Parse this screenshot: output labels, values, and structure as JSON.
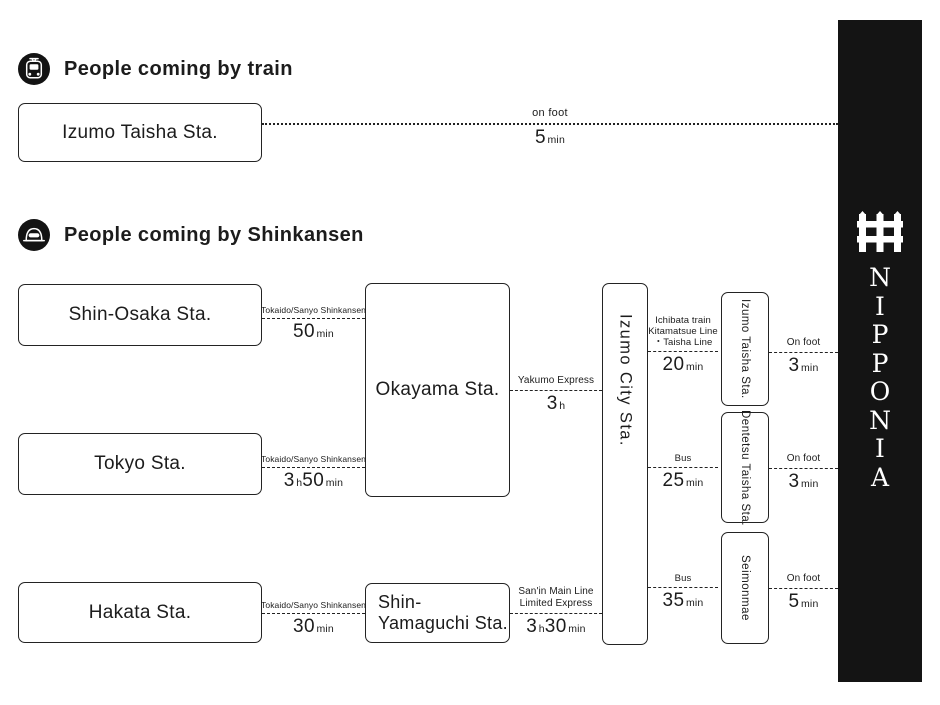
{
  "sections": {
    "train": {
      "heading": "People coming by train"
    },
    "shinkansen": {
      "heading": "People coming by Shinkansen"
    }
  },
  "stations": {
    "izumo_taisha_train": "Izumo Taisha Sta.",
    "shin_osaka": "Shin-Osaka Sta.",
    "tokyo": "Tokyo Sta.",
    "hakata": "Hakata Sta.",
    "okayama": "Okayama Sta.",
    "shin_yamaguchi": {
      "line1": "Shin-",
      "line2": "Yamaguchi Sta."
    },
    "izumo_city": "Izumo City Sta.",
    "izumo_taisha": "Izumo Taisha Sta.",
    "dentetsu_taisha": "Dentetsu Taisha Sta.",
    "seimonmae": "Seimonmae"
  },
  "routes": {
    "train_onfoot": {
      "l1": "on foot",
      "v1": "5",
      "u1": "min",
      "v2": "",
      "u2": ""
    },
    "shinosaka_okayama": {
      "l1": "Tokaido/Sanyo Shinkansen",
      "v1": "50",
      "u1": "min",
      "v2": "",
      "u2": ""
    },
    "tokyo_okayama": {
      "l1": "Tokaido/Sanyo Shinkansen",
      "v1": "3",
      "u1": "h",
      "v2": "50",
      "u2": "min"
    },
    "hakata_shinyamaguchi": {
      "l1": "Tokaido/Sanyo Shinkansen",
      "v1": "30",
      "u1": "min",
      "v2": "",
      "u2": ""
    },
    "okayama_izumocity": {
      "l1": "Yakumo Express",
      "v1": "3",
      "u1": "h",
      "v2": "",
      "u2": ""
    },
    "shinyamaguchi_izumocity": {
      "l1": "San'in Main Line",
      "l2": "Limited Express",
      "v1": "3",
      "u1": "h",
      "v2": "30",
      "u2": "min"
    },
    "izumocity_izumotaisha": {
      "l1": "Ichibata train",
      "l2": "Kitamatsue Line",
      "l3": "・Taisha Line",
      "v1": "20",
      "u1": "min",
      "v2": "",
      "u2": ""
    },
    "izumocity_dentetsu": {
      "l1": "Bus",
      "v1": "25",
      "u1": "min",
      "v2": "",
      "u2": ""
    },
    "izumocity_seimonmae": {
      "l1": "Bus",
      "v1": "35",
      "u1": "min",
      "v2": "",
      "u2": ""
    },
    "izumotaisha_nipponia": {
      "l1": "On foot",
      "v1": "3",
      "u1": "min",
      "v2": "",
      "u2": ""
    },
    "dentetsu_nipponia": {
      "l1": "On foot",
      "v1": "3",
      "u1": "min",
      "v2": "",
      "u2": ""
    },
    "seimonmae_nipponia": {
      "l1": "On foot",
      "v1": "5",
      "u1": "min",
      "v2": "",
      "u2": ""
    }
  },
  "brand": {
    "letters": [
      "N",
      "I",
      "P",
      "P",
      "O",
      "N",
      "I",
      "A"
    ],
    "bar_color": "#141414",
    "ink_color": "#1c1c1c"
  }
}
